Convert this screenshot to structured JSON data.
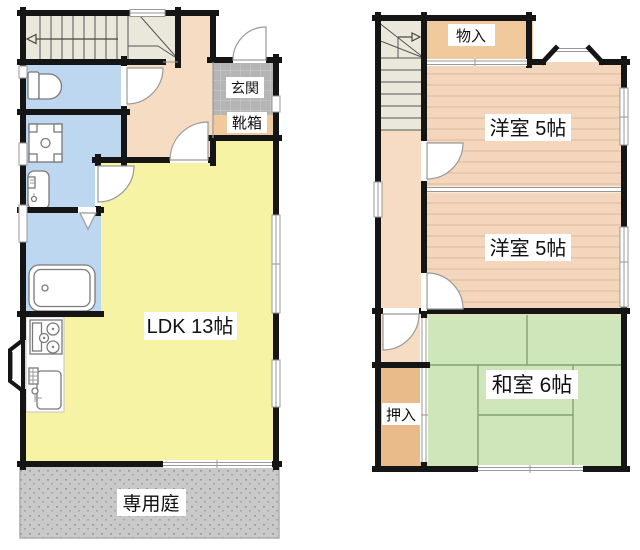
{
  "floor1": {
    "labels": {
      "genkan": "玄関",
      "shoebox": "靴箱",
      "ldk": "LDK 13帖",
      "garden": "専用庭"
    }
  },
  "floor2": {
    "labels": {
      "storage": "物入",
      "western_room_upper": "洋室 5帖",
      "western_room_lower": "洋室 5帖",
      "japanese_room": "和室 6帖",
      "closet": "押入"
    }
  },
  "colors": {
    "wall": "#151515",
    "stairs_cream": "#eae8db",
    "water_blue": "#bdd7f0",
    "hallway_peach": "#f5dcc3",
    "genkan_tile": "#b5b5b5",
    "shoebox_tan": "#f0c99c",
    "ldk_yellow": "#f7f3a5",
    "garden_gray": "#c9c9c9",
    "western_peach": "#f3d6bc",
    "japanese_green": "#cfe6ba",
    "closet_tan": "#e9ba8a",
    "storage_tan": "#f0c99c",
    "window_gray": "#999999"
  }
}
